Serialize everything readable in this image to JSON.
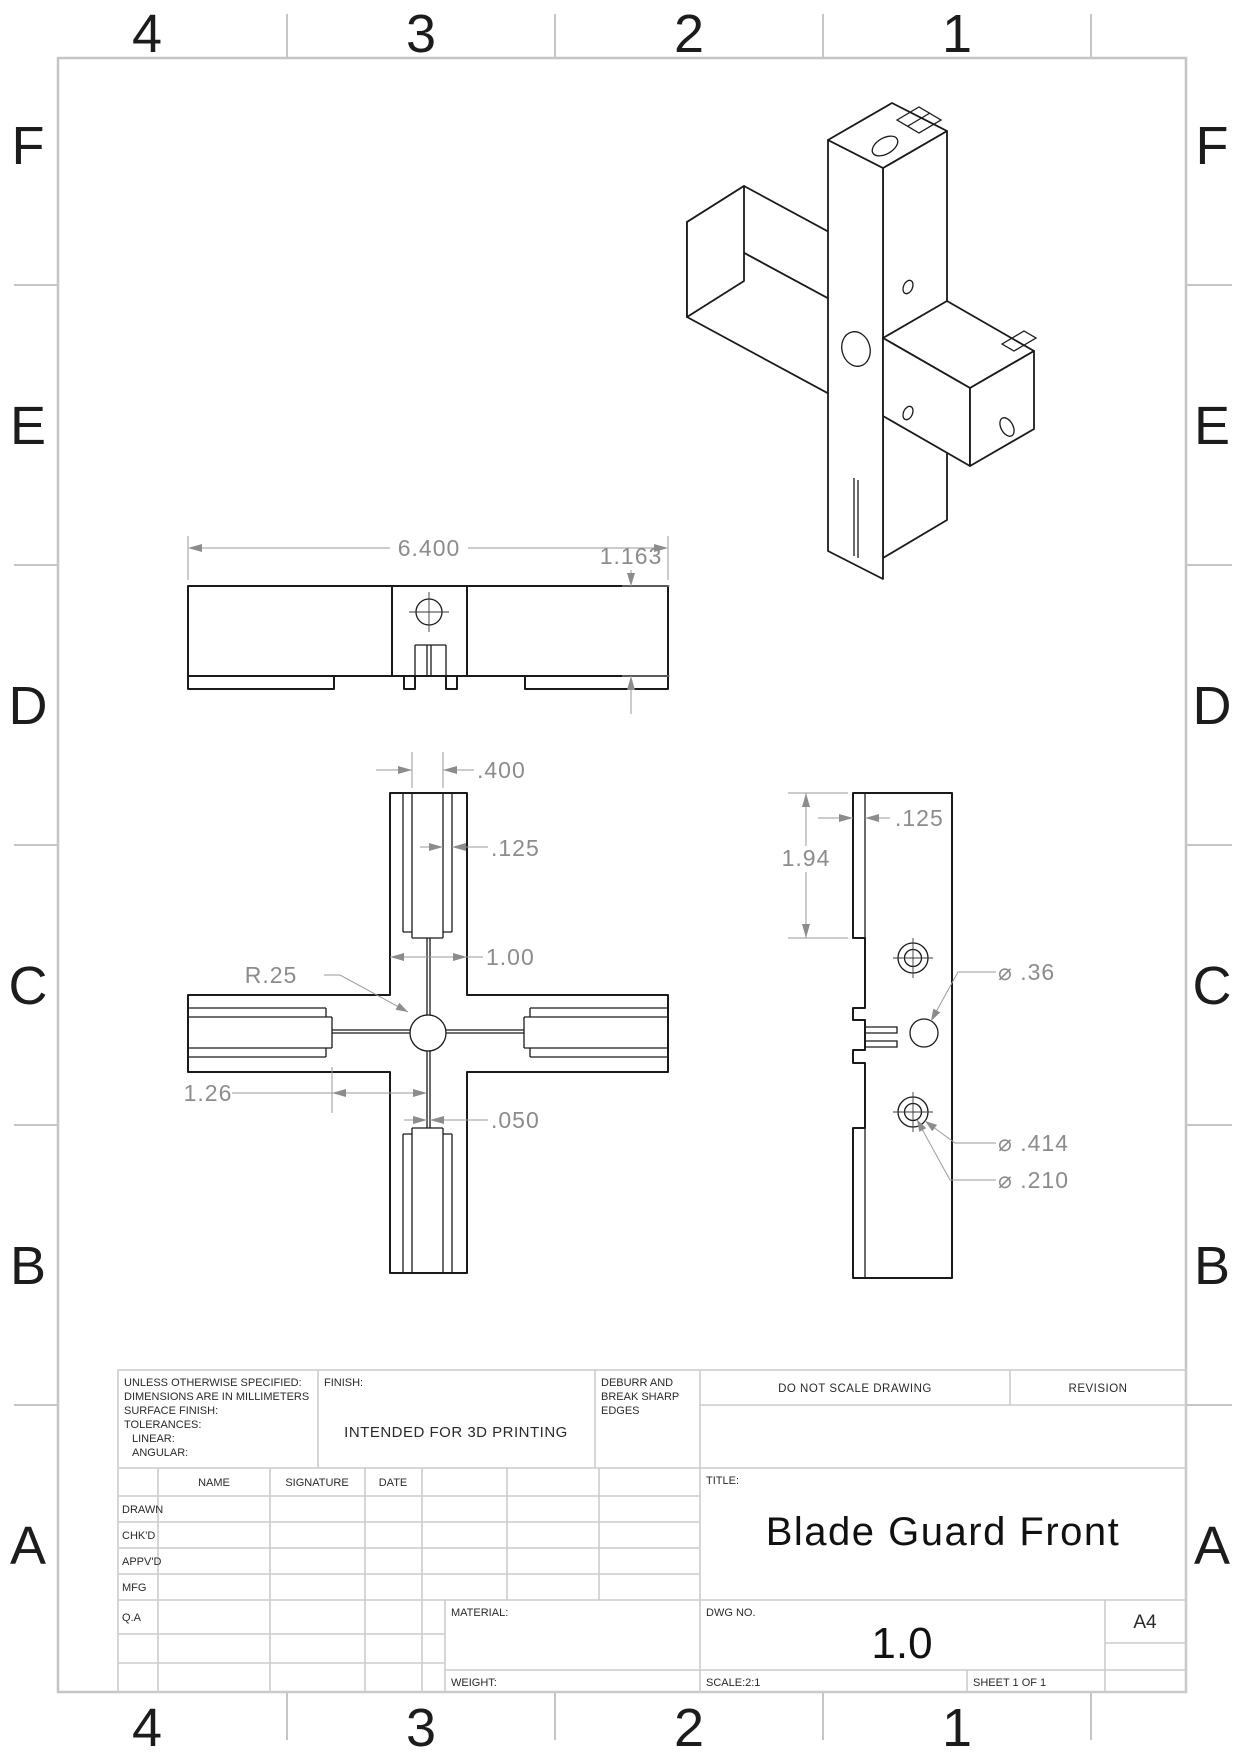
{
  "sheet": {
    "zone_columns": [
      "4",
      "3",
      "2",
      "1"
    ],
    "zone_rows": [
      "F",
      "E",
      "D",
      "C",
      "B",
      "A"
    ],
    "colors": {
      "frame": "#c5c5c5",
      "part_line": "#1a1a1a",
      "dimension": "#8c8c8c"
    }
  },
  "views": {
    "top": {
      "width": "6.400",
      "height": "1.163"
    },
    "front": {
      "pocket": ".400",
      "wall": ".125",
      "arm": "1.00",
      "radius": "R.25",
      "offset": "1.26",
      "slit": ".050"
    },
    "side": {
      "height": "1.94",
      "flange": ".125",
      "hole": "⌀ .36",
      "cbore": "⌀ .414",
      "drill": "⌀ .210"
    }
  },
  "title_block": {
    "tolerance_lines": [
      "UNLESS OTHERWISE SPECIFIED:",
      "DIMENSIONS ARE IN MILLIMETERS",
      "SURFACE FINISH:",
      "TOLERANCES:",
      "LINEAR:",
      "ANGULAR:"
    ],
    "finish_label": "FINISH:",
    "finish_value": "INTENDED FOR 3D PRINTING",
    "deburr_lines": [
      "DEBURR AND",
      "BREAK SHARP",
      "EDGES"
    ],
    "do_not_scale": "DO NOT SCALE DRAWING",
    "revision_label": "REVISION",
    "col_name": "NAME",
    "col_signature": "SIGNATURE",
    "col_date": "DATE",
    "row_labels": [
      "DRAWN",
      "CHK'D",
      "APPV'D",
      "MFG",
      "Q.A"
    ],
    "title_label": "TITLE:",
    "title": "Blade Guard Front",
    "material_label": "MATERIAL:",
    "weight_label": "WEIGHT:",
    "dwg_label": "DWG NO.",
    "dwg_no": "1.0",
    "paper_size": "A4",
    "scale_label": "SCALE:2:1",
    "sheet_label": "SHEET 1 OF 1"
  }
}
